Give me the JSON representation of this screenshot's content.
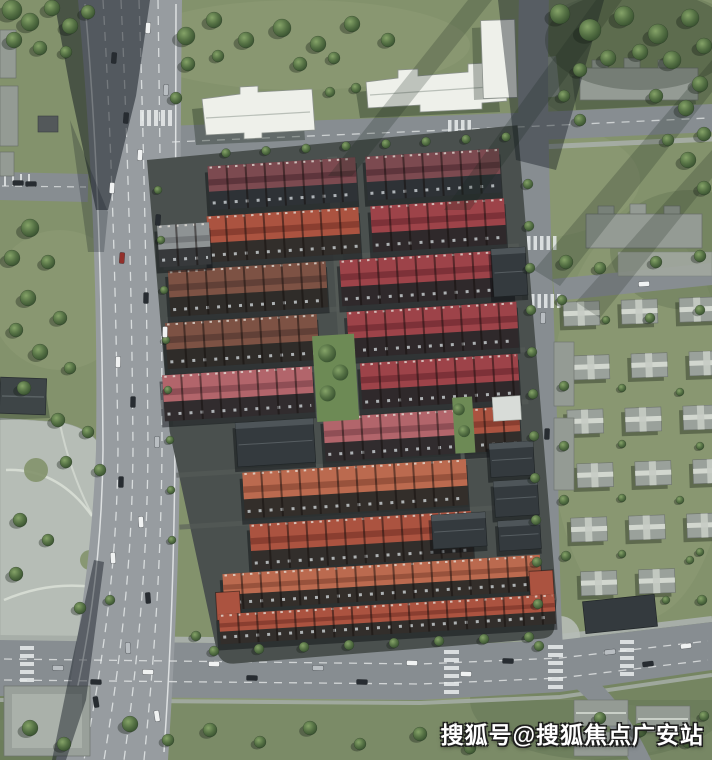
{
  "watermark": {
    "text": "搜狐号@搜狐焦点广安站"
  },
  "palette": {
    "grass": "#83926c",
    "grass_light": "#9aa77f",
    "grass_dark": "#55674a",
    "tree_light": "#7c9a62",
    "tree_dark": "#3c5637",
    "asphalt": "#878d91",
    "asphalt_light": "#979ca0",
    "pavement": "#b6bdb6",
    "sidewalk": "#a7aea8",
    "lane_marking": "#e9ecec",
    "white_building": "#eef0ea",
    "gray_building": "#949b94",
    "dark_building": "#343a3e",
    "estate_ground": "#4a504e",
    "courtyard_green": "#6d8a55",
    "roof_maroon": "#7c4a50",
    "roof_brick": "#ab5340",
    "roof_crimson": "#9d4349",
    "roof_brown": "#7d5244",
    "roof_terra": "#bb6a4f",
    "roof_pink": "#b2656b",
    "shadow": "#141c24",
    "car_white": "#f0f2f2",
    "car_dark": "#272c31",
    "car_silver": "#b9bec2",
    "car_red": "#93302b"
  }
}
